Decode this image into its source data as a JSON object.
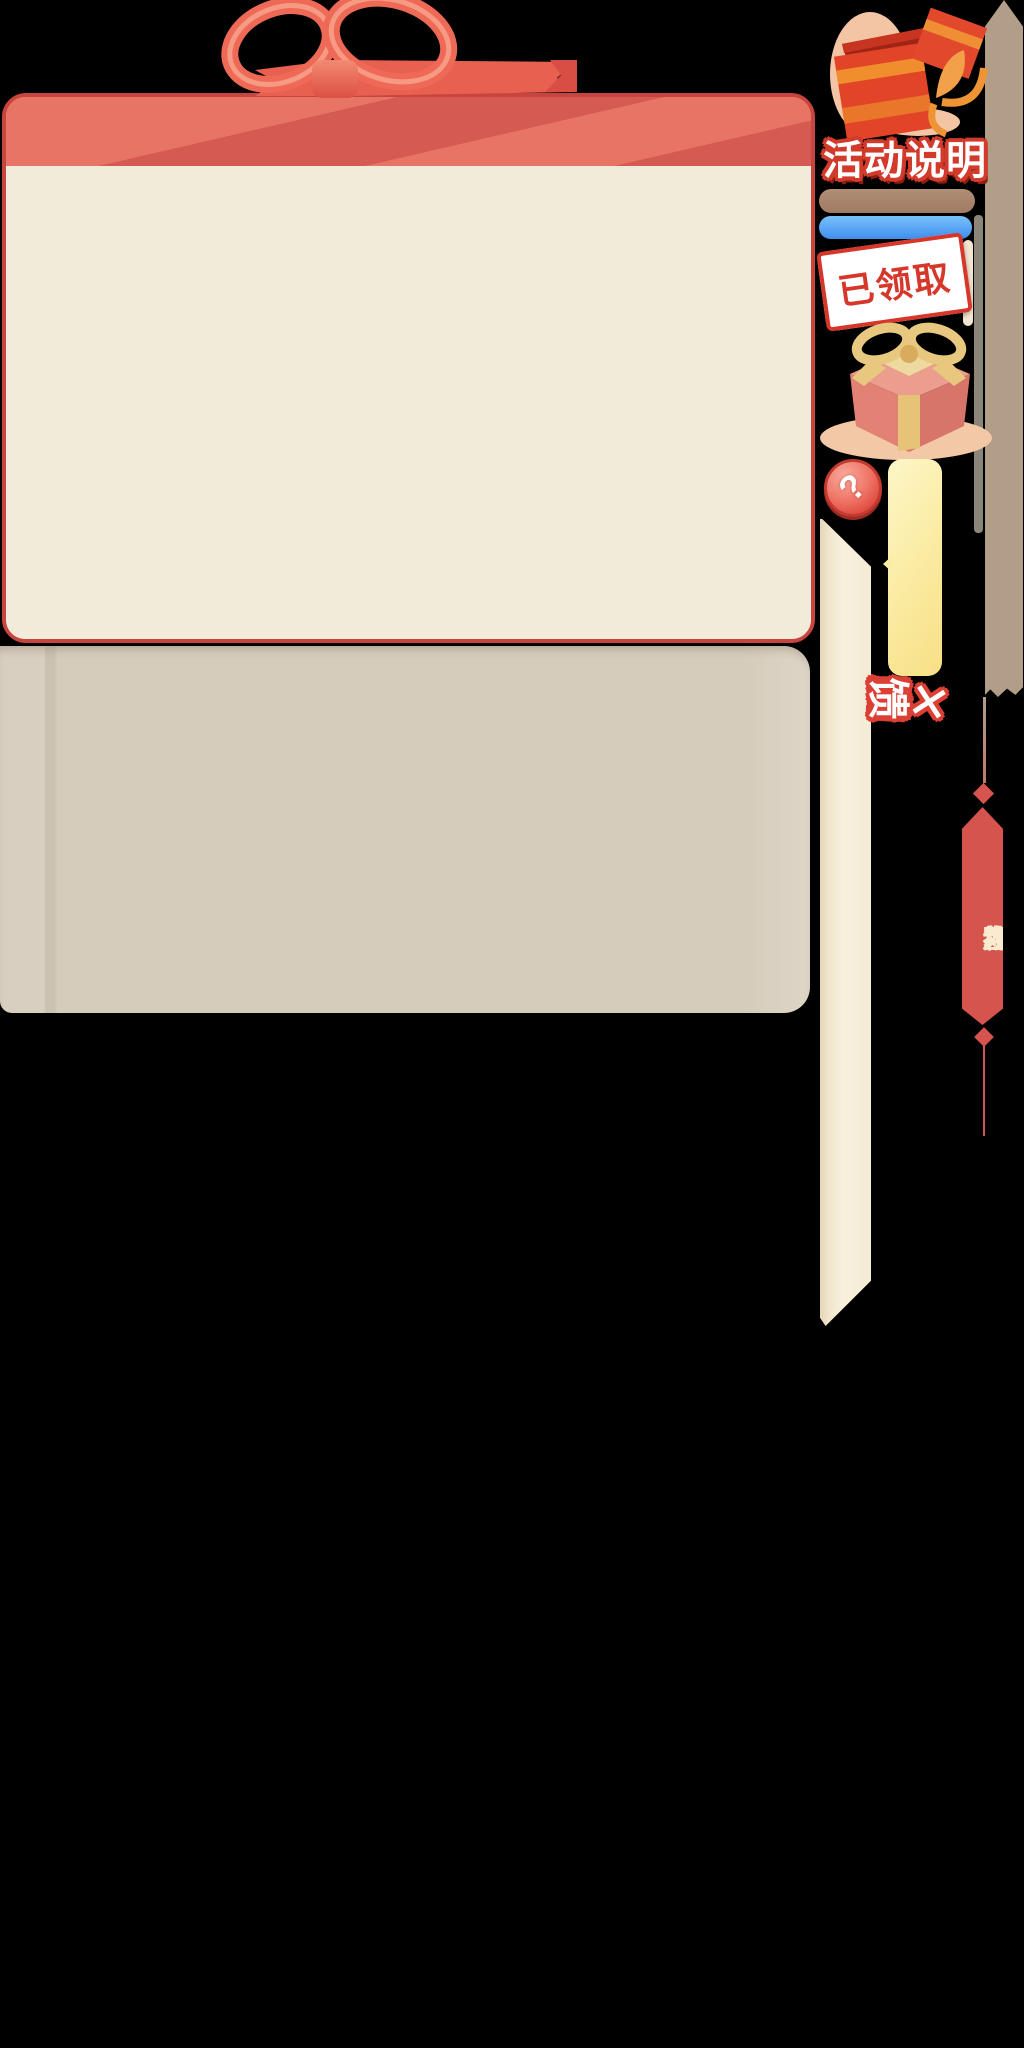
{
  "scene": {
    "width": 1024,
    "height": 2048,
    "background": "#000000"
  },
  "main_panel": {
    "ribbon_bow_icon": "ribbon-bow",
    "border_color": "#c7453e",
    "header_color": "#d55a52",
    "header_stripe_color": "#e87466",
    "body_color": "#f2ebda"
  },
  "secondary_panel": {
    "color": "#d5ccbc"
  },
  "right_rail": {
    "open_gift_icon": "open-gift-box",
    "section_title": "活动说明",
    "progress_bar_brown_color": "#a5826a",
    "progress_bar_blue_color": "#4a97f2",
    "claimed_stamp": "已领取",
    "stamp_color": "#d6372a",
    "closed_gift_icon": "gift-box",
    "help_icon": "?",
    "note_tab_color": "#f9e597",
    "scroll_rail_color": "#b29d89",
    "scroll_thumb_color": "#8b8678",
    "streamer_color": "#f6efdc"
  },
  "event_title": {
    "separator": "✕",
    "text": "庆国庆 互动大回馈",
    "fill_color": "#ffffff",
    "outline_color": "#dc4034"
  },
  "side_banner": {
    "label": "互动大礼包",
    "background_color": "#d5544d",
    "text_color": "#f9ead0"
  }
}
